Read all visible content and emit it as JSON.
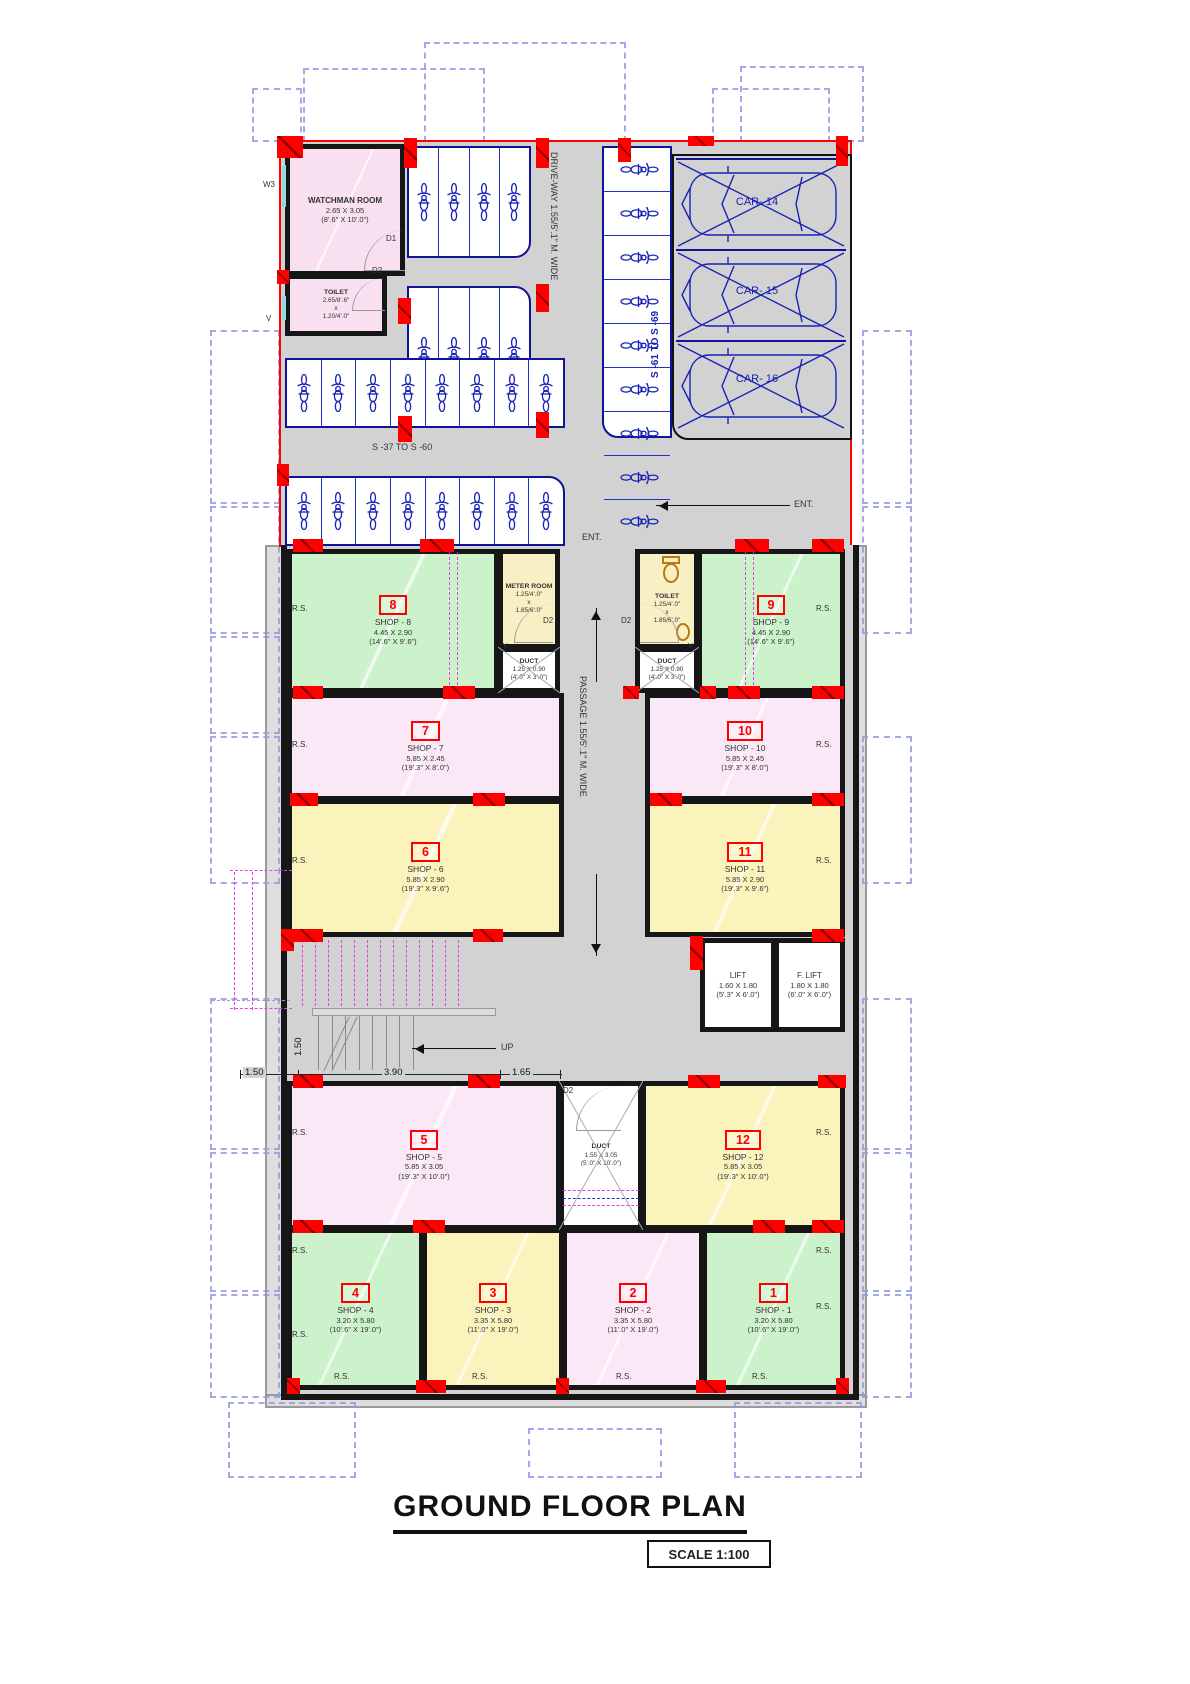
{
  "title": {
    "text": "GROUND FLOOR  PLAN",
    "scale": "SCALE 1:100"
  },
  "labels": {
    "rs": "R.S.",
    "ent": "ENT.",
    "up": "UP",
    "d1": "D1",
    "d2": "D2",
    "w3": "W3",
    "v": "V"
  },
  "dims": {
    "stair_width_v": "1.50",
    "seg1": "1.50",
    "seg2": "3.90",
    "seg3": "1.65"
  },
  "parking": {
    "driveway_label": "DRIVE-WAY 1.55/5'.1\" M. WIDE",
    "scooter_range_right": "S -61 TO S -69",
    "scooter_range_main": "S -37 TO S -60",
    "cars": [
      "CAR- 14",
      "CAR- 15",
      "CAR- 16"
    ],
    "bike_groups": {
      "top_a": 4,
      "top_b": 4,
      "row_c": 8,
      "row_d": 8,
      "right_strip": 9
    }
  },
  "rooms": {
    "watchman": {
      "title": "WATCHMAN ROOM",
      "m": "2.65 X 3.05",
      "ft": "(8'.6\" X 10'.0\")"
    },
    "wtoilet": {
      "title": "TOILET",
      "l1": "2.65/8'.6\"",
      "l2": "x",
      "l3": "1.20/4'.0\""
    },
    "meter": {
      "title": "METER ROOM",
      "l1": "1.25/4'.0\"",
      "l2": "x",
      "l3": "1.85/6'.0\""
    },
    "toilet": {
      "title": "TOILET",
      "l1": "1.25/4'.0\"",
      "l2": "x",
      "l3": "1.85/6'.0\""
    },
    "duct_small": {
      "title": "DUCT",
      "m": "1.25 X 0.90",
      "ft": "(4'.0\" X 3'.0\")"
    },
    "duct_big": {
      "title": "DUCT",
      "m": "1.55 X 3.05",
      "ft": "(5'.0\" X 10'.0\")"
    },
    "lift": {
      "title": "LIFT",
      "m": "1.60 X 1.80",
      "ft": "(5'.3\" X 6'.0\")"
    },
    "flift": {
      "title": "F. LIFT",
      "m": "1.80 X 1.80",
      "ft": "(6'.0\" X 6'.0\")"
    }
  },
  "passage_label": "PASSAGE 1.55/5'.1\" M. WIDE",
  "shops": {
    "s1": {
      "num": "1",
      "name": "SHOP - 1",
      "m": "3.20 X 5.80",
      "ft": "(10'.6\" X 19'.0\")"
    },
    "s2": {
      "num": "2",
      "name": "SHOP - 2",
      "m": "3.35 X 5.80",
      "ft": "(11'.0\" X 19'.0\")"
    },
    "s3": {
      "num": "3",
      "name": "SHOP - 3",
      "m": "3.35 X 5.80",
      "ft": "(11'.0\" X 19'.0\")"
    },
    "s4": {
      "num": "4",
      "name": "SHOP - 4",
      "m": "3.20 X 5.80",
      "ft": "(10'.6\" X 19'.0\")"
    },
    "s5": {
      "num": "5",
      "name": "SHOP - 5",
      "m": "5.85 X 3.05",
      "ft": "(19'.3\" X 10'.0\")"
    },
    "s6": {
      "num": "6",
      "name": "SHOP - 6",
      "m": "5.85 X 2.90",
      "ft": "(19'.3\" X 9'.6\")"
    },
    "s7": {
      "num": "7",
      "name": "SHOP - 7",
      "m": "5.85 X 2.45",
      "ft": "(19'.3\" X 8'.0\")"
    },
    "s8": {
      "num": "8",
      "name": "SHOP - 8",
      "m": "4.45 X 2.90",
      "ft": "(14'.6\" X 9'.6\")"
    },
    "s9": {
      "num": "9",
      "name": "SHOP - 9",
      "m": "4.45 X 2.90",
      "ft": "(14'.6\" X 9'.6\")"
    },
    "s10": {
      "num": "10",
      "name": "SHOP - 10",
      "m": "5.85 X 2.45",
      "ft": "(19'.3\" X 8'.0\")"
    },
    "s11": {
      "num": "11",
      "name": "SHOP - 11",
      "m": "5.85 X 2.90",
      "ft": "(19'.3\" X 9'.6\")"
    },
    "s12": {
      "num": "12",
      "name": "SHOP - 12",
      "m": "5.85 X 3.05",
      "ft": "(19'.3\" X 10'.0\")"
    }
  },
  "colors": {
    "shop_green": "#ccf2cc",
    "shop_pink": "#fbe8f6",
    "shop_yellow": "#faf3bc",
    "room_cream": "#f8f0c4",
    "passage_gray": "#d2d2d2",
    "column_red": "#fe0000",
    "vehicle_blue": "#1822b4",
    "overhead_magenta": "#e83ce8",
    "context_periwinkle": "#959ce0"
  }
}
